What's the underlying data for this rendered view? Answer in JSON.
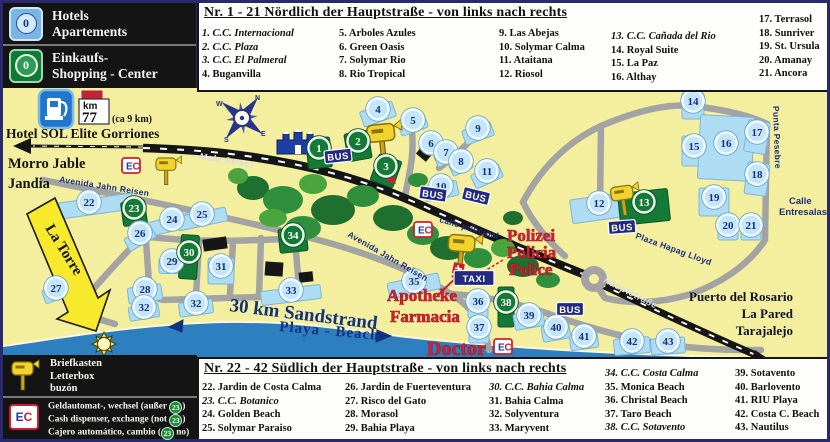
{
  "colors": {
    "sea": "#2e7fc0",
    "map_bg": "#f4ef9f",
    "marker_green": "#157a36",
    "marker_blue": "#c4e6f8",
    "sign_navy": "#232a80",
    "accent_red": "#cf1f30",
    "lot_blue": "#aedcf2"
  },
  "legend_top": {
    "hotels": {
      "badge": "0",
      "line1": "Hotels",
      "line2": "Apartements"
    },
    "shopping": {
      "badge": "0",
      "line1": "Einkaufs-",
      "line2": "Shopping - Center"
    }
  },
  "fuel": {
    "km_label": "km",
    "km_value": "77",
    "note": "(ca 9 km)"
  },
  "north_list": {
    "title": "Nr. 1 - 21 Nördlich der Hauptstraße - von links nach rechts",
    "cols": [
      {
        "x": 3,
        "y": 24,
        "items": [
          {
            "t": "1. C.C. Internacional",
            "i": true
          },
          {
            "t": "2. C.C. Plaza",
            "i": true
          },
          {
            "t": "3. C.C. El Palmeral",
            "i": true
          },
          {
            "t": "4. Buganvilla",
            "i": false
          }
        ]
      },
      {
        "x": 140,
        "y": 24,
        "items": [
          {
            "t": "5. Arboles Azules",
            "i": false
          },
          {
            "t": "6. Green Oasis",
            "i": false
          },
          {
            "t": "7. Solymar Rio",
            "i": false
          },
          {
            "t": "8. Rio Tropical",
            "i": false
          }
        ]
      },
      {
        "x": 300,
        "y": 24,
        "items": [
          {
            "t": "9. Las Abejas",
            "i": false
          },
          {
            "t": "10. Solymar Calma",
            "i": false
          },
          {
            "t": "11. Ataitana",
            "i": false
          },
          {
            "t": "12. Riosol",
            "i": false
          }
        ]
      },
      {
        "x": 412,
        "y": 27,
        "items": [
          {
            "t": "13. C.C. Cañada del Rio",
            "i": true
          },
          {
            "t": "14. Royal Suite",
            "i": false
          },
          {
            "t": "15. La Paz",
            "i": false
          },
          {
            "t": "16. Althay",
            "i": false
          }
        ]
      },
      {
        "x": 560,
        "y": 10,
        "items": [
          {
            "t": "17. Terrasol",
            "i": false
          },
          {
            "t": "18. Sunriver",
            "i": false
          },
          {
            "t": "19. St. Ursula",
            "i": false
          },
          {
            "t": "20. Amanay",
            "i": false
          },
          {
            "t": "21. Ancora",
            "i": false
          }
        ]
      }
    ]
  },
  "south_list": {
    "title": "Nr. 22 - 42 Südlich der Hauptstraße - von links nach rechts",
    "cols": [
      {
        "x": 3,
        "y": 22,
        "items": [
          {
            "t": "22. Jardin de Costa Calma",
            "i": false
          },
          {
            "t": "23. C.C. Botanico",
            "i": true
          },
          {
            "t": "24. Golden Beach",
            "i": false
          },
          {
            "t": "25. Solymar Paraiso",
            "i": false
          }
        ]
      },
      {
        "x": 146,
        "y": 22,
        "items": [
          {
            "t": "26. Jardin de Fuerteventura",
            "i": false
          },
          {
            "t": "27. Risco del Gato",
            "i": false
          },
          {
            "t": "28. Morasol",
            "i": false
          },
          {
            "t": "29. Bahia Playa",
            "i": false
          }
        ]
      },
      {
        "x": 290,
        "y": 22,
        "items": [
          {
            "t": "30. C.C. Bahia Calma",
            "i": true
          },
          {
            "t": "31. Bahia Calma",
            "i": false
          },
          {
            "t": "32. Solyventura",
            "i": false
          },
          {
            "t": "33. Maryvent",
            "i": false
          }
        ]
      },
      {
        "x": 406,
        "y": 8,
        "items": [
          {
            "t": "34. C.C. Costa Calma",
            "i": true
          },
          {
            "t": "35. Monica Beach",
            "i": false
          },
          {
            "t": "36. Christal Beach",
            "i": false
          },
          {
            "t": "37. Taro Beach",
            "i": false
          },
          {
            "t": "38. C.C. Sotavento",
            "i": true
          }
        ]
      },
      {
        "x": 536,
        "y": 8,
        "items": [
          {
            "t": "39. Sotavento",
            "i": false
          },
          {
            "t": "40. Barlovento",
            "i": false
          },
          {
            "t": "41. RIU Playa",
            "i": false
          },
          {
            "t": "42. Costa C. Beach",
            "i": false
          },
          {
            "t": "43. Nautilus",
            "i": false
          }
        ]
      }
    ]
  },
  "legend_bottom": {
    "letterbox_lines": [
      "Briefkasten",
      "Letterbox",
      "buzón"
    ],
    "ec_letters": {
      "e": "E",
      "c": "C"
    },
    "atm_lines": [
      {
        "pre": "Geldautomat-, wechsel (außer ",
        "badge": "23",
        "post": ")"
      },
      {
        "pre": "Cash dispenser, exchange (not ",
        "badge": "23",
        "post": ")"
      },
      {
        "pre": "Cajero automático, cambio (",
        "badge": "23",
        "post": " no)"
      }
    ]
  },
  "map": {
    "compass_letters": [
      "N",
      "E",
      "S",
      "W"
    ],
    "markers": [
      {
        "n": "1",
        "g": 1,
        "x": 316,
        "y": 60,
        "lw": 24,
        "lh": 30,
        "la": -6
      },
      {
        "n": "2",
        "g": 1,
        "x": 355,
        "y": 53,
        "lw": 24,
        "lh": 28,
        "la": -10
      },
      {
        "n": "3",
        "g": 1,
        "x": 383,
        "y": 78,
        "lw": 24,
        "lh": 28,
        "la": 20
      },
      {
        "n": "4",
        "x": 375,
        "y": 21,
        "lw": 34,
        "lh": 16,
        "la": -20
      },
      {
        "n": "5",
        "x": 410,
        "y": 32,
        "lw": 28,
        "lh": 14,
        "la": -20
      },
      {
        "n": "6",
        "x": 428,
        "y": 55,
        "lw": 22,
        "lh": 13,
        "la": -25
      },
      {
        "n": "7",
        "x": 443,
        "y": 64,
        "lw": 22,
        "lh": 13,
        "la": -25
      },
      {
        "n": "8",
        "x": 458,
        "y": 73,
        "lw": 22,
        "lh": 13,
        "la": -25
      },
      {
        "n": "9",
        "x": 475,
        "y": 40,
        "lw": 30,
        "lh": 15,
        "la": -20
      },
      {
        "n": "10",
        "x": 438,
        "y": 98,
        "lw": 34,
        "lh": 15,
        "la": -12
      },
      {
        "n": "11",
        "x": 484,
        "y": 83,
        "lw": 30,
        "lh": 15,
        "la": -25
      },
      {
        "n": "12",
        "x": 596,
        "y": 115,
        "lw": 56,
        "lh": 24,
        "la": -8
      },
      {
        "n": "13",
        "g": 1,
        "x": 641,
        "y": 114,
        "lw": 50,
        "lh": 32,
        "la": -6
      },
      {
        "n": "14",
        "x": 690,
        "y": 13,
        "lw": 22,
        "lh": 26,
        "la": 0
      },
      {
        "n": "15",
        "x": 691,
        "y": 58,
        "lw": 24,
        "lh": 30,
        "la": 0
      },
      {
        "n": "16",
        "x": 723,
        "y": 55,
        "lw": 54,
        "lh": 64,
        "la": 3
      },
      {
        "n": "17",
        "x": 754,
        "y": 44,
        "lw": 22,
        "lh": 32,
        "la": 10
      },
      {
        "n": "18",
        "x": 754,
        "y": 86,
        "lw": 22,
        "lh": 32,
        "la": 8
      },
      {
        "n": "19",
        "x": 711,
        "y": 109,
        "lw": 30,
        "lh": 28,
        "la": 0
      },
      {
        "n": "20",
        "x": 725,
        "y": 137,
        "lw": 20,
        "lh": 20,
        "la": 0
      },
      {
        "n": "21",
        "x": 748,
        "y": 137,
        "lw": 20,
        "lh": 20,
        "la": 0
      },
      {
        "n": "22",
        "x": 86,
        "y": 114,
        "lw": 88,
        "lh": 16,
        "la": -8
      },
      {
        "n": "23",
        "g": 1,
        "x": 131,
        "y": 120,
        "lw": 24,
        "lh": 24,
        "la": -8
      },
      {
        "n": "24",
        "x": 169,
        "y": 131,
        "lw": 52,
        "lh": 14,
        "la": -14
      },
      {
        "n": "25",
        "x": 199,
        "y": 126,
        "lw": 50,
        "lh": 14,
        "la": -12
      },
      {
        "n": "26",
        "x": 137,
        "y": 145,
        "lw": 30,
        "lh": 14,
        "la": -30
      },
      {
        "n": "27",
        "x": 53,
        "y": 200,
        "lw": 26,
        "lh": 14,
        "la": -20
      },
      {
        "n": "28",
        "x": 142,
        "y": 201,
        "lw": 34,
        "lh": 16,
        "la": -8
      },
      {
        "n": "29",
        "x": 169,
        "y": 173,
        "lw": 26,
        "lh": 15,
        "la": 0
      },
      {
        "n": "30",
        "g": 1,
        "x": 186,
        "y": 164,
        "lw": 18,
        "lh": 44,
        "la": 4
      },
      {
        "n": "31",
        "x": 218,
        "y": 178,
        "lw": 26,
        "lh": 26,
        "la": 0
      },
      {
        "n": "32",
        "x": 141,
        "y": 219,
        "lw": 30,
        "lh": 14,
        "la": -10
      },
      {
        "n": "32",
        "x": 193,
        "y": 215,
        "lw": 34,
        "lh": 14,
        "la": -8
      },
      {
        "n": "33",
        "x": 288,
        "y": 202,
        "lw": 60,
        "lh": 14,
        "la": -7
      },
      {
        "n": "34",
        "g": 1,
        "x": 290,
        "y": 147,
        "lw": 28,
        "lh": 24,
        "la": -6
      },
      {
        "n": "35",
        "x": 411,
        "y": 193,
        "lw": 52,
        "lh": 16,
        "la": -12
      },
      {
        "n": "36",
        "x": 475,
        "y": 213,
        "lw": 20,
        "lh": 24,
        "la": 0
      },
      {
        "n": "37",
        "x": 476,
        "y": 239,
        "lw": 20,
        "lh": 22,
        "la": 0
      },
      {
        "n": "38",
        "g": 1,
        "x": 503,
        "y": 214,
        "lw": 16,
        "lh": 40,
        "la": 0
      },
      {
        "n": "39",
        "x": 526,
        "y": 227,
        "lw": 30,
        "lh": 16,
        "la": -10
      },
      {
        "n": "40",
        "x": 553,
        "y": 239,
        "lw": 28,
        "lh": 16,
        "la": -10
      },
      {
        "n": "41",
        "x": 581,
        "y": 248,
        "lw": 28,
        "lh": 16,
        "la": -8
      },
      {
        "n": "42",
        "x": 629,
        "y": 253,
        "lw": 36,
        "lh": 16,
        "la": -5
      },
      {
        "n": "43",
        "x": 665,
        "y": 253,
        "lw": 34,
        "lh": 16,
        "la": -4
      }
    ],
    "signs": [
      {
        "t": "BUS",
        "x": 335,
        "y": 68,
        "r": -6
      },
      {
        "t": "BUS",
        "x": 430,
        "y": 106,
        "r": 8
      },
      {
        "t": "BUS",
        "x": 473,
        "y": 108,
        "r": 14
      },
      {
        "t": "BUS",
        "x": 619,
        "y": 139,
        "r": -4
      },
      {
        "t": "BUS",
        "x": 567,
        "y": 221,
        "r": 0
      },
      {
        "t": "TAXI",
        "x": 471,
        "y": 190,
        "r": 0
      }
    ],
    "labels": [
      {
        "t": "Mala Street",
        "x": 196,
        "y": 71,
        "r": 9,
        "c": "road"
      },
      {
        "t": "Avenida Jahn Reisen",
        "x": 56,
        "y": 94,
        "r": 9,
        "c": "st"
      },
      {
        "t": "Avenida Jahn Reisen",
        "x": 344,
        "y": 148,
        "r": 30,
        "c": "st"
      },
      {
        "t": "calle principal",
        "x": 436,
        "y": 134,
        "r": 16,
        "c": "st"
      },
      {
        "t": "Plaza Hapag Lloyd",
        "x": 632,
        "y": 150,
        "r": 20,
        "c": "st"
      },
      {
        "t": "Hauptstraße",
        "x": 600,
        "y": 194,
        "r": 27,
        "c": "road"
      },
      {
        "t": "Punta Pesebre",
        "x": 770,
        "y": 18,
        "r": 88,
        "c": "st"
      },
      {
        "t": "Calle",
        "x": 786,
        "y": 116,
        "r": 0,
        "c": "st2"
      },
      {
        "t": "Entresalas",
        "x": 776,
        "y": 127,
        "r": 0,
        "c": "st2"
      },
      {
        "t": "30 km Sandstrand",
        "x": 226,
        "y": 223,
        "r": 7,
        "c": "bb"
      },
      {
        "t": "Playa - Beach",
        "x": 276,
        "y": 243,
        "r": 5,
        "c": "bm"
      },
      {
        "t": "Puerto del Rosario",
        "x": 790,
        "y": 213,
        "c": "dest",
        "a": "end"
      },
      {
        "t": "La Pared",
        "x": 790,
        "y": 230,
        "c": "dest",
        "a": "end"
      },
      {
        "t": "Tarajalejo",
        "x": 790,
        "y": 247,
        "c": "dest",
        "a": "end"
      },
      {
        "t": "Polizei",
        "x": 504,
        "y": 153,
        "c": "red"
      },
      {
        "t": "Policia",
        "x": 504,
        "y": 170,
        "c": "red"
      },
      {
        "t": "Police",
        "x": 506,
        "y": 187,
        "c": "red"
      },
      {
        "t": "Apotheke",
        "x": 384,
        "y": 213,
        "c": "red"
      },
      {
        "t": "Farmacia",
        "x": 387,
        "y": 234,
        "c": "red"
      },
      {
        "t": "Doctor",
        "x": 424,
        "y": 267,
        "c": "redXL"
      },
      {
        "t": "Hotel SOL Elite Gorriones",
        "x": 3,
        "y": 50,
        "c": "wb"
      },
      {
        "t": "Morro Jable",
        "x": 5,
        "y": 80,
        "c": "wb2"
      },
      {
        "t": "Jandia",
        "x": 5,
        "y": 100,
        "c": "wb2"
      },
      {
        "t": "(ca 9 km)",
        "x": 109,
        "y": 34,
        "c": "note"
      },
      {
        "t": "La Torre",
        "x": 42,
        "y": 140,
        "r": 58,
        "c": "torre"
      }
    ]
  }
}
